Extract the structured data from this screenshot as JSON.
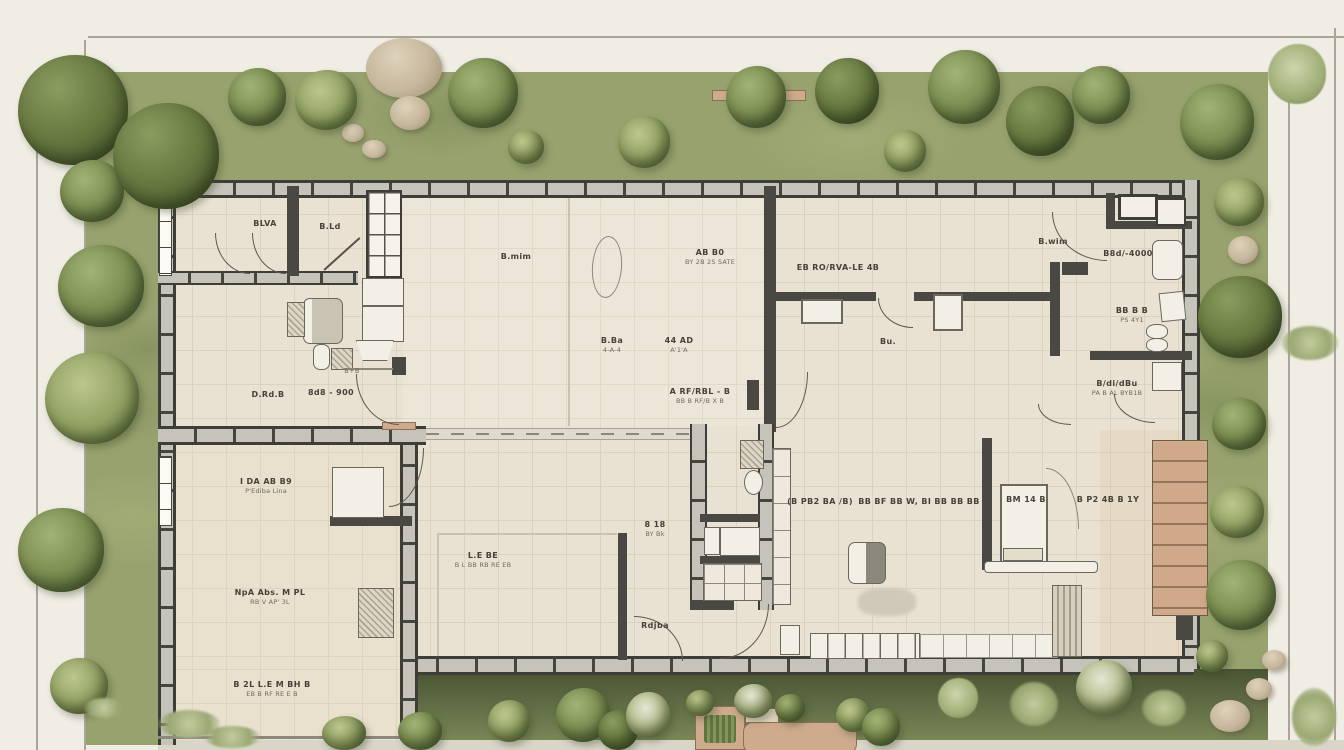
{
  "title": "Residential floor plan - top view with landscaped garden",
  "palette": {
    "paper": "#f0ede4",
    "floor": "#e9e2d2",
    "wall": "#3e3d38",
    "garden": "#97a26e",
    "garden_shadow": "#495432",
    "tree_green": "#6c7c47",
    "wood": "#cfa98a",
    "rock": "#c6b79c"
  },
  "icons": {
    "tree": "circular-canopy-shape",
    "rock": "beige-ellipse",
    "door": "quarter-arc",
    "window": "framed-white-bar",
    "stairs": "striped-wood-treads"
  },
  "annotations": [
    {
      "l1": "BLVA",
      "l2": ""
    },
    {
      "l1": "B.Ld",
      "l2": ""
    },
    {
      "l1": "B.mim",
      "l2": ""
    },
    {
      "l1": "B.wim",
      "l2": ""
    },
    {
      "l1": "AB B0",
      "l2": "BY 2B 2S SATE"
    },
    {
      "l1": "EB RO/RVA-LE 4B",
      "l2": ""
    },
    {
      "l1": "B.Ba",
      "l2": "4-A-4"
    },
    {
      "l1": "44 AD",
      "l2": "A'1'A"
    },
    {
      "l1": "A RF/RBL - B",
      "l2": "BB B RF/B X B"
    },
    {
      "l1": "D.Rd.B",
      "l2": ""
    },
    {
      "l1": "8d8 - 900",
      "l2": ""
    },
    {
      "l1": "Bu.",
      "l2": ""
    },
    {
      "l1": "B8d/-4000",
      "l2": ""
    },
    {
      "l1": "BB B B",
      "l2": "PS 4Y1"
    },
    {
      "l1": "B/di/dBu",
      "l2": "PA B AL BYB1B"
    },
    {
      "l1": "I DA AB B9",
      "l2": "P'Ediba Lina"
    },
    {
      "l1": "NpA Abs. M PL",
      "l2": "RB V AP' 3L"
    },
    {
      "l1": "B 2L L.E M BH B",
      "l2": "EB B RF RE E B"
    },
    {
      "l1": "L.E BE",
      "l2": "B L BB RB RE EB"
    },
    {
      "l1": "8 18",
      "l2": "BY Bk"
    },
    {
      "l1": "Rdjba",
      "l2": ""
    },
    {
      "l1": "(B PB2 BA /B)",
      "l2": ""
    },
    {
      "l1": "BB BF BB W, BI BB BB BB",
      "l2": ""
    },
    {
      "l1": "BM 14 B",
      "l2": ""
    },
    {
      "l1": "B P2 4B B 1Y",
      "l2": ""
    },
    {
      "l1": "B+B",
      "l2": ""
    }
  ]
}
